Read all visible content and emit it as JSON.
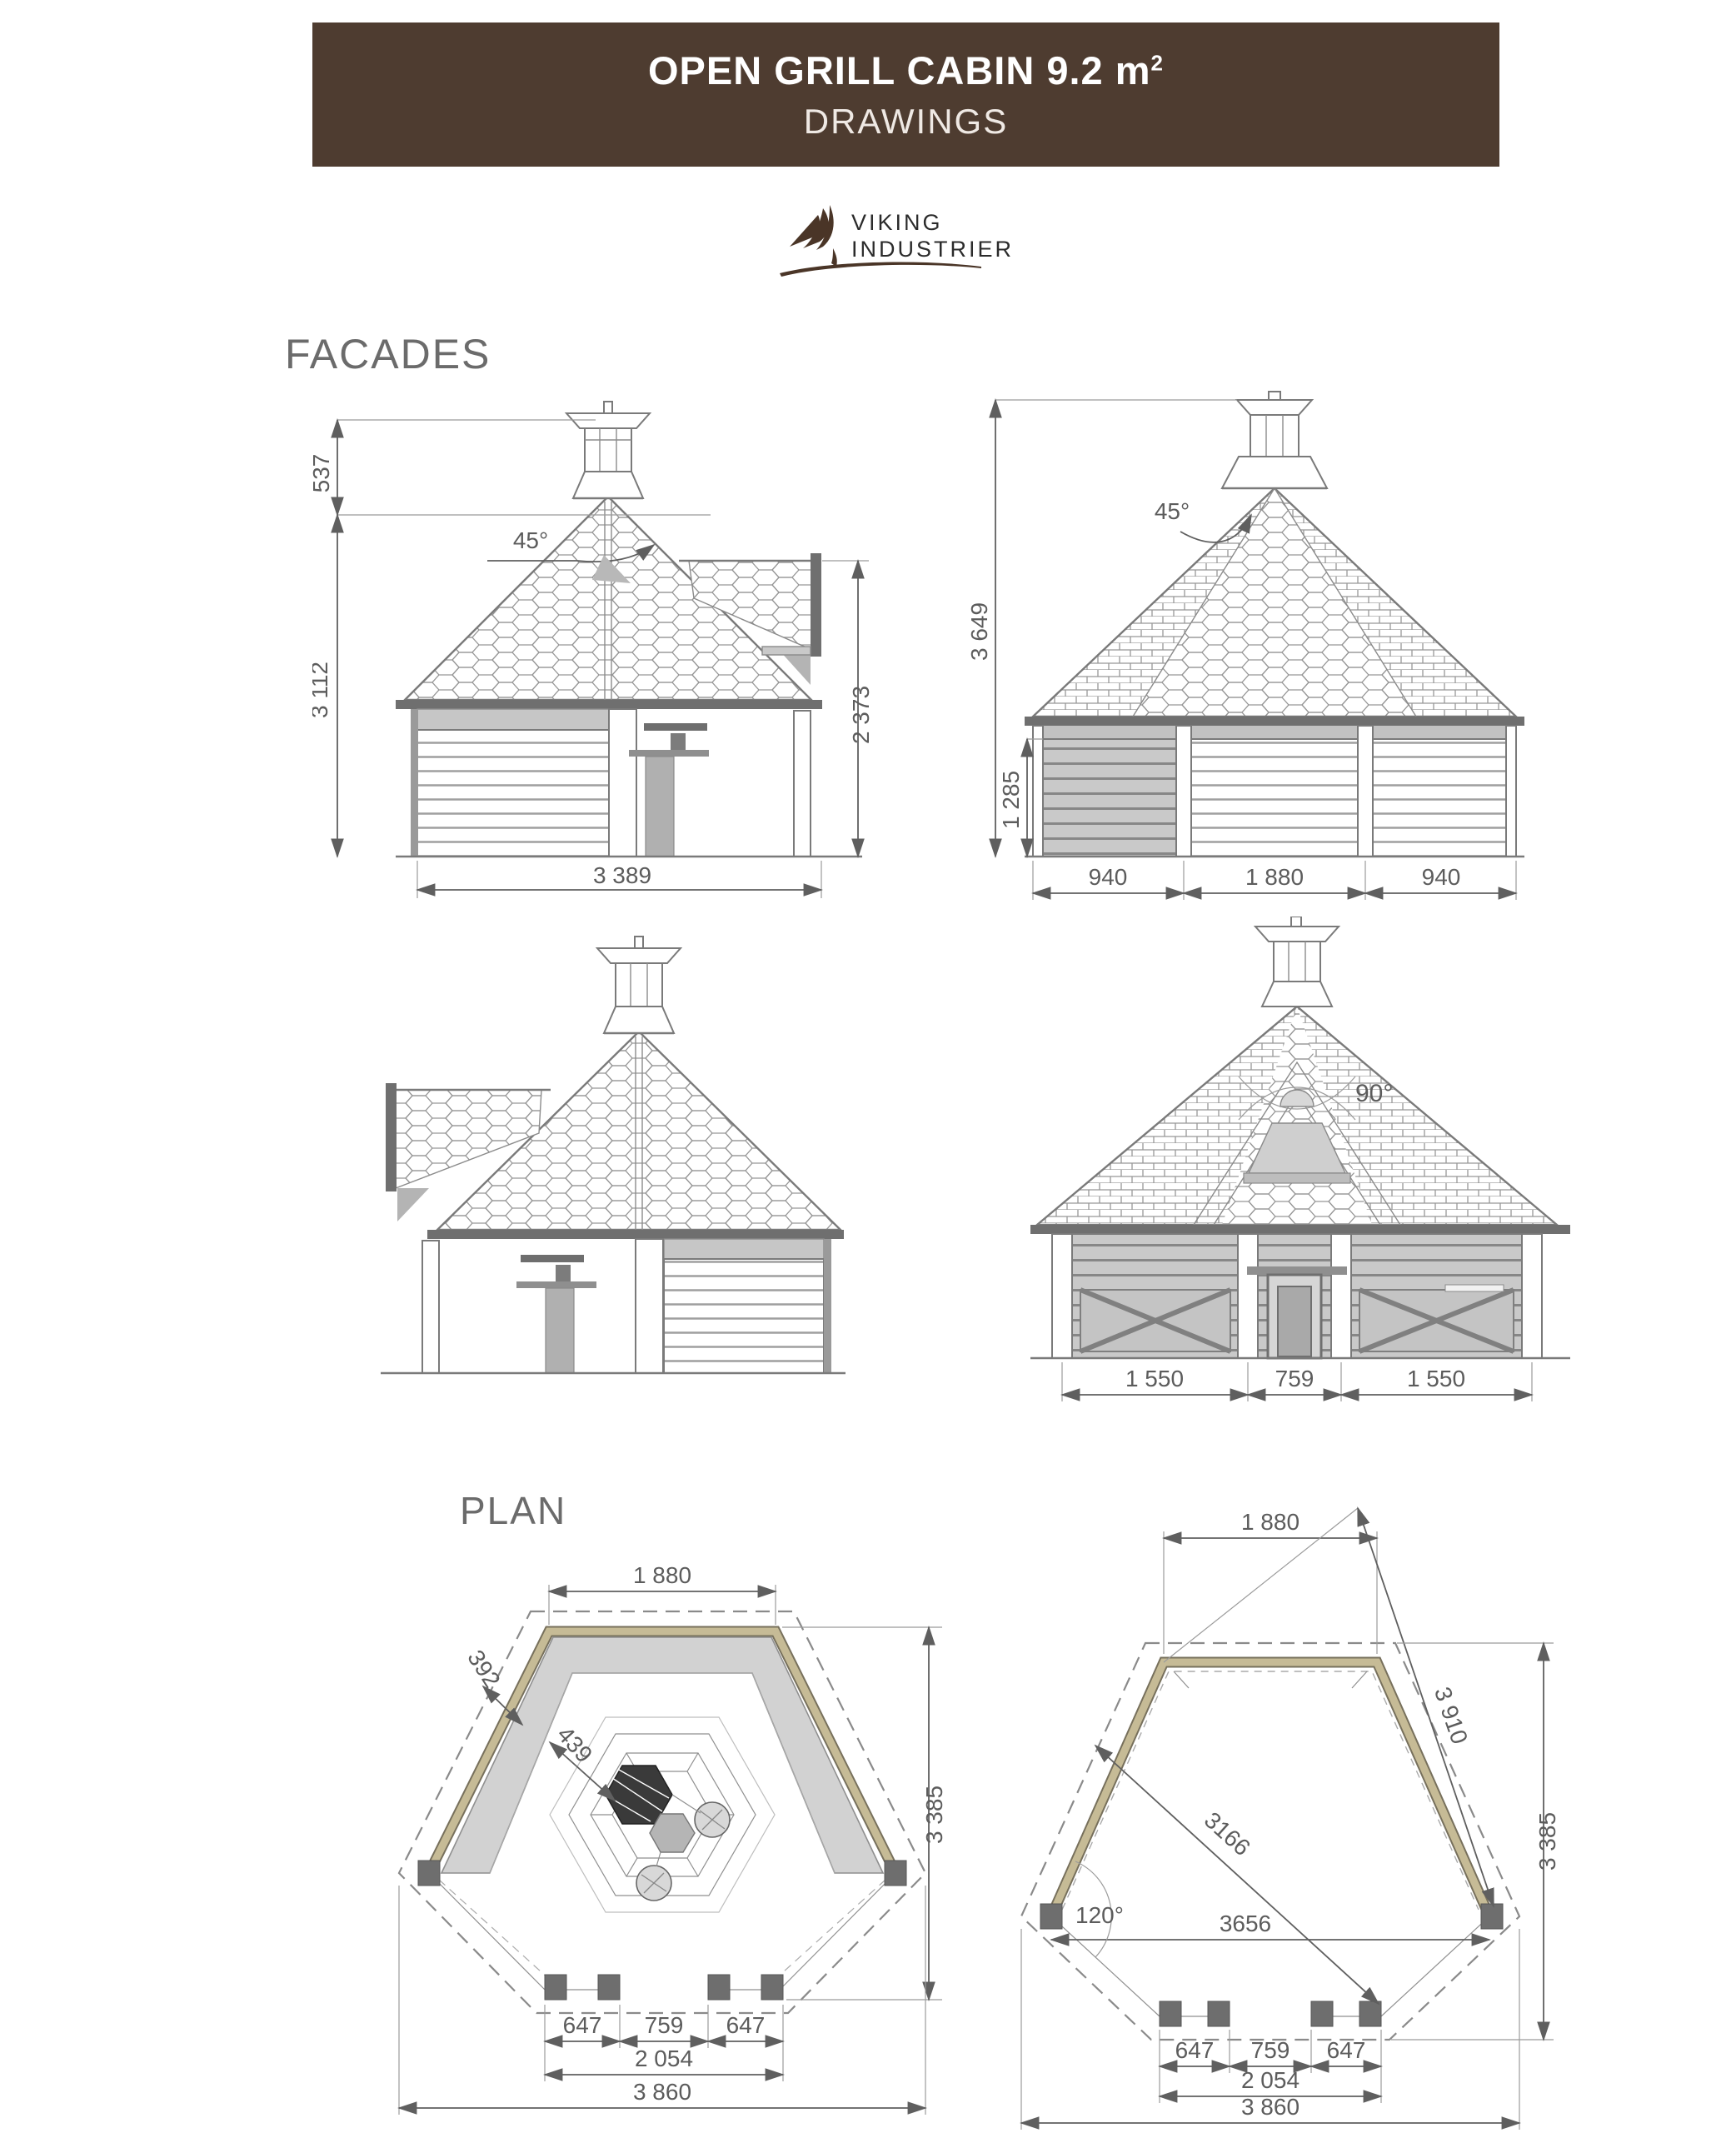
{
  "header": {
    "title_main": "OPEN GRILL CABIN 9.2 m",
    "title_sup": "2",
    "subtitle": "DRAWINGS"
  },
  "logo": {
    "icon": "viking-sail-icon",
    "name_top": "VIKING",
    "name_bottom": "INDUSTRIER"
  },
  "headings": {
    "facades": "FACADES",
    "plan": "PLAN"
  },
  "facade_side_right": {
    "dim_chimney_height": "537",
    "dim_body_height": "3 112",
    "roof_angle": "45°",
    "dim_porch_height": "2 373",
    "dim_total_width": "3 389"
  },
  "facade_front": {
    "dim_total_height": "3 649",
    "dim_wall_height": "1 285",
    "roof_angle": "45°",
    "dim_left_panel": "940",
    "dim_center_panel": "1 880",
    "dim_right_panel": "940"
  },
  "facade_open_front": {
    "roof_angle": "90°",
    "dim_left_wall": "1 550",
    "dim_door": "759",
    "dim_right_wall": "1 550"
  },
  "plan_left": {
    "dim_top_wall": "1 880",
    "dim_overhang": "392",
    "dim_bench_depth": "439",
    "dim_height": "3 385",
    "dim_front_wall_left": "647",
    "dim_door": "759",
    "dim_front_wall_right": "647",
    "dim_front_total": "2 054",
    "dim_total_width": "3 860"
  },
  "plan_right": {
    "dim_top_wall": "1 880",
    "dim_roof_diagonal": "3 910",
    "dim_inner_diagonal": "3166",
    "dim_span": "3656",
    "corner_angle": "120°",
    "dim_height": "3 385",
    "dim_front_wall_left": "647",
    "dim_door": "759",
    "dim_front_wall_right": "647",
    "dim_front_total": "2 054",
    "dim_total_width": "3 860"
  },
  "colors": {
    "header_bg": "#4e3c30",
    "logo_brown": "#4a3527",
    "wall_khaki": "#c6bb96",
    "bench_gray": "#d2d2d2",
    "footing_gray": "#6e6e6e",
    "drawing_line": "#7a7a7a",
    "dim_line": "#5f5f5f"
  }
}
